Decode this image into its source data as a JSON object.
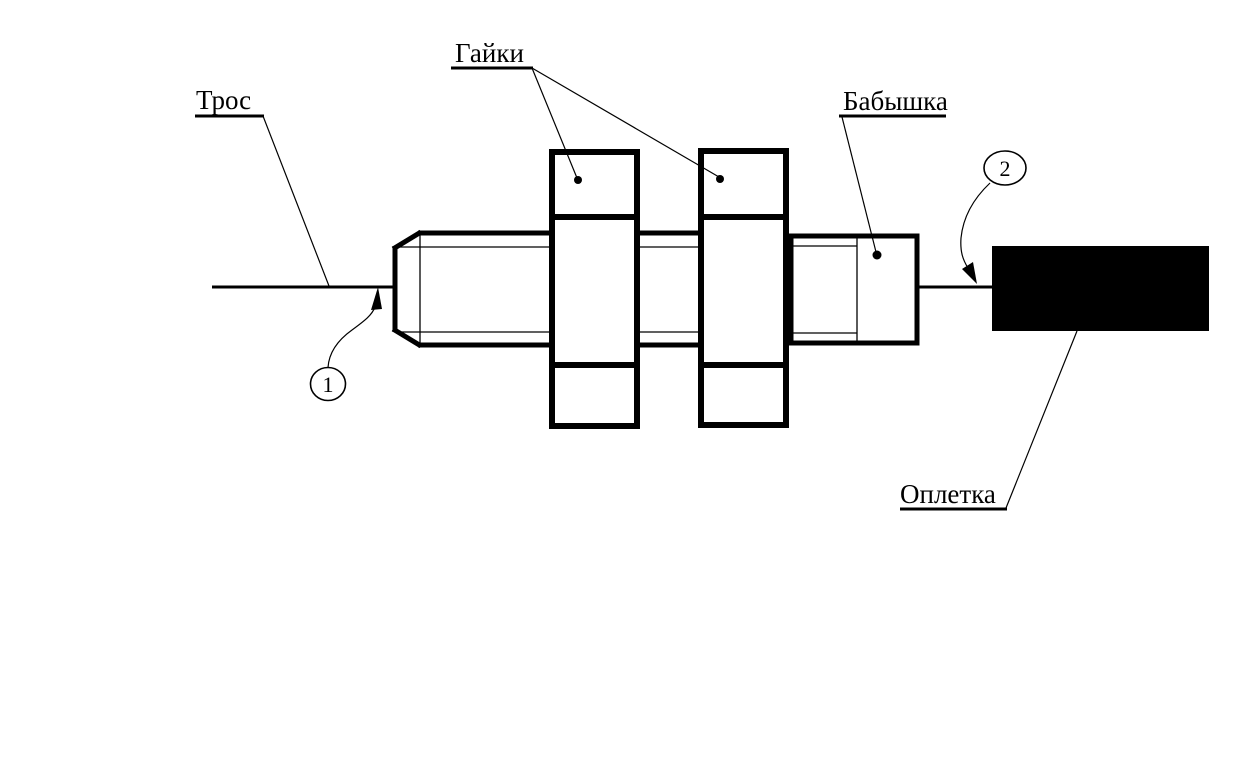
{
  "diagram": {
    "type": "engineering-line-drawing",
    "subject": "cable-turnbuckle-assembly",
    "colors": {
      "ink": "#000000",
      "background": "#ffffff",
      "braid_fill": "#000000"
    },
    "labels": {
      "cable": "Трос",
      "nuts": "Гайки",
      "boss": "Бабышка",
      "braid": "Оплетка"
    },
    "callouts": {
      "c1": "1",
      "c2": "2"
    }
  }
}
